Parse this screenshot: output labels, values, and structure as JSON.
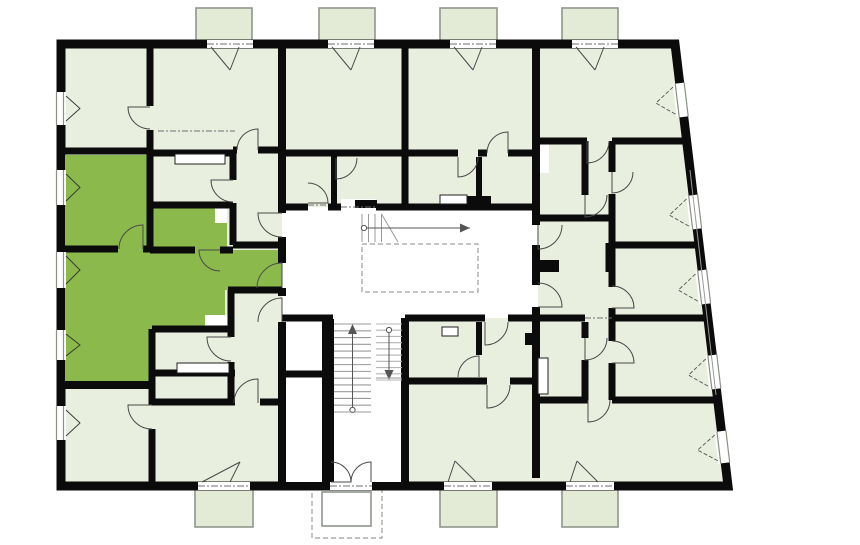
{
  "plan": {
    "canvas": {
      "width": 860,
      "height": 545,
      "background": "#ffffff"
    },
    "palette": {
      "room_fill": "#e9efdf",
      "balcony_fill": "#e3ebd7",
      "highlight_fill": "#8bb94c",
      "wall": "#0b0b0b",
      "door_stroke": "#4a4a4a",
      "window_frame": "#8b9185",
      "stair_tread": "#9a9a9a",
      "stair_tread_light": "#b5b5b5",
      "arrow": "#555555",
      "dash": "#6f6f6f",
      "balcony_stroke": "#8f968c",
      "canopy_stroke": "#a9ada3",
      "site_line": "#9a9a9a",
      "fixture_stroke": "#222222"
    },
    "footprint": {
      "points": "61,44 675,44 728,486 61,486",
      "wall_width": 9
    },
    "white_areas": {
      "corridor_path": "M282,207 L527,207 Q538,207 538,218 L538,308 Q538,318 527,318 L282,318 Z",
      "stair_block": {
        "x": 282,
        "y": 318,
        "w": 123,
        "h": 164
      }
    },
    "highlight_apartment": {
      "points": "65,155 150,155 150,208 227,208 227,250 282,250 282,290 225,290 225,329 152,329 152,385 65,385"
    },
    "white_rects": [
      {
        "x": 215,
        "y": 206,
        "w": 12,
        "h": 17
      },
      {
        "x": 205,
        "y": 315,
        "w": 23,
        "h": 14
      },
      {
        "x": 537,
        "y": 142,
        "w": 12,
        "h": 31
      },
      {
        "x": 341,
        "y": 199,
        "w": 35,
        "h": 9
      }
    ],
    "walls": [
      [
        61,
        151,
        150,
        151,
        7
      ],
      [
        150,
        153,
        233,
        153,
        7
      ],
      [
        150,
        205,
        233,
        205,
        7
      ],
      [
        61,
        249,
        118,
        249,
        7
      ],
      [
        143,
        249,
        152,
        249,
        7
      ],
      [
        150,
        250,
        195,
        250,
        7
      ],
      [
        220,
        250,
        233,
        250,
        7
      ],
      [
        233,
        245,
        282,
        245,
        7
      ],
      [
        233,
        150,
        237,
        150,
        7
      ],
      [
        258,
        150,
        282,
        150,
        7
      ],
      [
        285,
        153,
        405,
        153,
        7
      ],
      [
        405,
        153,
        458,
        153,
        7
      ],
      [
        478,
        153,
        487,
        153,
        7
      ],
      [
        508,
        153,
        536,
        153,
        7
      ],
      [
        536,
        141,
        587,
        141,
        7
      ],
      [
        612,
        141,
        688,
        141,
        7
      ],
      [
        536,
        218,
        612,
        218,
        7
      ],
      [
        612,
        245,
        698,
        245,
        7
      ],
      [
        533,
        266,
        559,
        266,
        11
      ],
      [
        282,
        207,
        308,
        207,
        7
      ],
      [
        328,
        207,
        341,
        207,
        7
      ],
      [
        376,
        207,
        538,
        207,
        7
      ],
      [
        282,
        318,
        333,
        318,
        7
      ],
      [
        405,
        318,
        485,
        318,
        7
      ],
      [
        508,
        318,
        538,
        318,
        7
      ],
      [
        536,
        318,
        585,
        318,
        7
      ],
      [
        612,
        318,
        707,
        318,
        7
      ],
      [
        282,
        374,
        328,
        374,
        7
      ],
      [
        405,
        381,
        487,
        381,
        7
      ],
      [
        510,
        381,
        536,
        381,
        7
      ],
      [
        536,
        400,
        588,
        400,
        7
      ],
      [
        612,
        400,
        715,
        400,
        7
      ],
      [
        228,
        290,
        282,
        290,
        7
      ],
      [
        152,
        329,
        231,
        329,
        7
      ],
      [
        152,
        373,
        235,
        373,
        7
      ],
      [
        152,
        402,
        235,
        402,
        7
      ],
      [
        260,
        402,
        282,
        402,
        7
      ],
      [
        61,
        385,
        152,
        385,
        8
      ],
      [
        150,
        44,
        150,
        106,
        7
      ],
      [
        150,
        130,
        150,
        250,
        7
      ],
      [
        282,
        44,
        282,
        213,
        8
      ],
      [
        282,
        237,
        282,
        263,
        8
      ],
      [
        282,
        288,
        282,
        296,
        8
      ],
      [
        282,
        322,
        282,
        482,
        8
      ],
      [
        405,
        44,
        405,
        207,
        7
      ],
      [
        405,
        318,
        405,
        482,
        8
      ],
      [
        536,
        44,
        536,
        225,
        8
      ],
      [
        536,
        245,
        536,
        285,
        8
      ],
      [
        536,
        307,
        536,
        478,
        8
      ],
      [
        233,
        150,
        233,
        180,
        7
      ],
      [
        233,
        203,
        233,
        245,
        7
      ],
      [
        231,
        290,
        231,
        337,
        7
      ],
      [
        231,
        362,
        231,
        402,
        7
      ],
      [
        328,
        319,
        328,
        482,
        12
      ],
      [
        334,
        153,
        334,
        207,
        6
      ],
      [
        479,
        157,
        479,
        207,
        6
      ],
      [
        479,
        322,
        479,
        355,
        6
      ],
      [
        585,
        141,
        585,
        195,
        7
      ],
      [
        585,
        322,
        585,
        338,
        7
      ],
      [
        585,
        360,
        585,
        400,
        7
      ],
      [
        609,
        243,
        609,
        272,
        7
      ],
      [
        612,
        141,
        612,
        172,
        7
      ],
      [
        612,
        194,
        612,
        287,
        7
      ],
      [
        612,
        308,
        612,
        341,
        7
      ],
      [
        612,
        363,
        612,
        400,
        7
      ],
      [
        152,
        329,
        152,
        385,
        7
      ],
      [
        152,
        385,
        152,
        405,
        7
      ],
      [
        152,
        429,
        152,
        482,
        7
      ]
    ],
    "black_rects": [
      {
        "x": 467,
        "y": 196,
        "w": 24,
        "h": 8
      },
      {
        "x": 533,
        "y": 260,
        "w": 26,
        "h": 12
      },
      {
        "x": 525,
        "y": 333,
        "w": 9,
        "h": 12
      },
      {
        "x": 355,
        "y": 200,
        "w": 22,
        "h": 8
      }
    ],
    "balconies": [
      {
        "x": 196,
        "y": 8,
        "w": 56,
        "h": 36,
        "side": "top"
      },
      {
        "x": 319,
        "y": 8,
        "w": 56,
        "h": 36,
        "side": "top"
      },
      {
        "x": 440,
        "y": 8,
        "w": 57,
        "h": 36,
        "side": "top"
      },
      {
        "x": 562,
        "y": 8,
        "w": 56,
        "h": 36,
        "side": "top"
      },
      {
        "x": 195,
        "y": 486,
        "w": 58,
        "h": 41,
        "side": "bottom"
      },
      {
        "x": 440,
        "y": 486,
        "w": 57,
        "h": 41,
        "side": "bottom"
      },
      {
        "x": 562,
        "y": 486,
        "w": 56,
        "h": 41,
        "side": "bottom"
      }
    ],
    "canopy": {
      "outer": {
        "x": 312,
        "y": 486,
        "w": 70,
        "h": 52
      },
      "inner": {
        "x": 322,
        "y": 492,
        "w": 49,
        "h": 34
      }
    },
    "thresholds": [
      {
        "x": 207,
        "y": 40,
        "w": 46,
        "h": 8
      },
      {
        "x": 328,
        "y": 40,
        "w": 46,
        "h": 8
      },
      {
        "x": 450,
        "y": 40,
        "w": 46,
        "h": 8
      },
      {
        "x": 572,
        "y": 40,
        "w": 46,
        "h": 8
      },
      {
        "x": 198,
        "y": 482,
        "w": 52,
        "h": 8
      },
      {
        "x": 330,
        "y": 482,
        "w": 42,
        "h": 8
      },
      {
        "x": 444,
        "y": 482,
        "w": 48,
        "h": 8
      },
      {
        "x": 566,
        "y": 482,
        "w": 48,
        "h": 8
      }
    ],
    "fixtures": [
      {
        "x": 175,
        "y": 154,
        "w": 50,
        "h": 10
      },
      {
        "x": 177,
        "y": 363,
        "w": 52,
        "h": 10
      },
      {
        "x": 440,
        "y": 195,
        "w": 27,
        "h": 9
      },
      {
        "x": 442,
        "y": 327,
        "w": 16,
        "h": 9
      },
      {
        "x": 538,
        "y": 358,
        "w": 10,
        "h": 36
      }
    ],
    "windows_left": [
      {
        "y": 92,
        "h": 33
      },
      {
        "y": 170,
        "h": 35
      },
      {
        "y": 252,
        "h": 36
      },
      {
        "y": 330,
        "h": 30
      },
      {
        "y": 406,
        "h": 34
      }
    ],
    "windows_slant": [
      {
        "yc": 100,
        "h": 34
      },
      {
        "yc": 212,
        "h": 34
      },
      {
        "yc": 287,
        "h": 34
      },
      {
        "yc": 372,
        "h": 34
      },
      {
        "yc": 447,
        "h": 32
      }
    ],
    "slant": {
      "x_at_y44": 675,
      "dx_per_dy": 0.1199,
      "angle_deg": -6.84
    },
    "doors": [
      {
        "cx": 150,
        "cy": 107,
        "r": 22,
        "a1": 90,
        "a2": 180
      },
      {
        "cx": 258,
        "cy": 150,
        "r": 21,
        "a1": 180,
        "a2": 270
      },
      {
        "cx": 233,
        "cy": 180,
        "r": 22,
        "a1": 90,
        "a2": 180
      },
      {
        "cx": 220,
        "cy": 250,
        "r": 21,
        "a1": 90,
        "a2": 180
      },
      {
        "cx": 143,
        "cy": 249,
        "r": 24,
        "a1": 180,
        "a2": 270
      },
      {
        "cx": 282,
        "cy": 288,
        "r": 25,
        "a1": 180,
        "a2": 270
      },
      {
        "cx": 282,
        "cy": 213,
        "r": 24,
        "a1": 90,
        "a2": 180
      },
      {
        "cx": 308,
        "cy": 203,
        "r": 20,
        "a1": 270,
        "a2": 360
      },
      {
        "cx": 336,
        "cy": 158,
        "r": 21,
        "a1": 0,
        "a2": 90
      },
      {
        "cx": 587,
        "cy": 141,
        "r": 22,
        "a1": 0,
        "a2": 90
      },
      {
        "cx": 538,
        "cy": 225,
        "r": 24,
        "a1": 0,
        "a2": 90
      },
      {
        "cx": 538,
        "cy": 307,
        "r": 24,
        "a1": 270,
        "a2": 360
      },
      {
        "cx": 612,
        "cy": 172,
        "r": 21,
        "a1": 0,
        "a2": 90
      },
      {
        "cx": 612,
        "cy": 308,
        "r": 22,
        "a1": 270,
        "a2": 360
      },
      {
        "cx": 585,
        "cy": 195,
        "r": 22,
        "a1": 0,
        "a2": 90
      },
      {
        "cx": 612,
        "cy": 363,
        "r": 22,
        "a1": 270,
        "a2": 360
      },
      {
        "cx": 585,
        "cy": 338,
        "r": 22,
        "a1": 0,
        "a2": 90
      },
      {
        "cx": 588,
        "cy": 400,
        "r": 22,
        "a1": 0,
        "a2": 90
      },
      {
        "cx": 485,
        "cy": 322,
        "r": 23,
        "a1": 0,
        "a2": 90
      },
      {
        "cx": 479,
        "cy": 377,
        "r": 21,
        "a1": 180,
        "a2": 270
      },
      {
        "cx": 487,
        "cy": 385,
        "r": 23,
        "a1": 0,
        "a2": 90
      },
      {
        "cx": 282,
        "cy": 322,
        "r": 24,
        "a1": 180,
        "a2": 270
      },
      {
        "cx": 231,
        "cy": 337,
        "r": 24,
        "a1": 90,
        "a2": 180
      },
      {
        "cx": 258,
        "cy": 403,
        "r": 24,
        "a1": 180,
        "a2": 270
      },
      {
        "cx": 152,
        "cy": 405,
        "r": 24,
        "a1": 90,
        "a2": 180
      },
      {
        "cx": 508,
        "cy": 153,
        "r": 21,
        "a1": 180,
        "a2": 270
      },
      {
        "cx": 458,
        "cy": 157,
        "r": 20,
        "a1": 0,
        "a2": 90
      },
      {
        "cx": 331,
        "cy": 482,
        "r": 20,
        "a1": 270,
        "a2": 360
      },
      {
        "cx": 371,
        "cy": 482,
        "r": 20,
        "a1": 180,
        "a2": 270
      }
    ],
    "fans": [
      {
        "x1": 211,
        "y1": 47,
        "x2": 239,
        "y2": 47,
        "ax": 230,
        "ay": 70
      },
      {
        "x1": 332,
        "y1": 47,
        "x2": 360,
        "y2": 47,
        "ax": 351,
        "ay": 70
      },
      {
        "x1": 454,
        "y1": 47,
        "x2": 482,
        "y2": 47,
        "ax": 473,
        "ay": 70
      },
      {
        "x1": 576,
        "y1": 47,
        "x2": 604,
        "y2": 47,
        "ax": 595,
        "ay": 70
      },
      {
        "x1": 202,
        "y1": 482,
        "x2": 230,
        "y2": 482,
        "ax": 240,
        "ay": 462
      },
      {
        "x1": 448,
        "y1": 482,
        "x2": 476,
        "y2": 482,
        "ax": 455,
        "ay": 461
      },
      {
        "x1": 570,
        "y1": 482,
        "x2": 598,
        "y2": 482,
        "ax": 577,
        "ay": 461
      }
    ],
    "stairs": {
      "flight_up": {
        "x": 334,
        "y": 324,
        "w": 37,
        "h": 88,
        "steps": 13
      },
      "flight_down": {
        "x": 376,
        "y": 324,
        "w": 26,
        "h": 56,
        "steps": 9
      },
      "ramp": {
        "tread_xs": [
          362,
          368.5,
          375,
          381.5
        ],
        "y1": 214,
        "y2": 242,
        "diag": {
          "x1": 381.5,
          "y1": 214,
          "x2": 398,
          "y2": 242
        },
        "arrow": {
          "x1": 364,
          "x2": 470,
          "y": 228
        }
      },
      "void_rect": {
        "x": 362,
        "y": 244,
        "w": 116,
        "h": 48
      },
      "landing_lines": [
        [
          334,
          412,
          371,
          412
        ],
        [
          376,
          378,
          402,
          378
        ]
      ]
    },
    "dash_lines": [
      [
        341,
        207,
        376,
        207
      ],
      [
        308,
        205,
        328,
        205
      ],
      [
        158,
        131,
        235,
        131
      ],
      [
        585,
        318,
        612,
        318
      ]
    ],
    "site_line": {
      "x1": 690,
      "y1": 170,
      "x2": 716,
      "y2": 395
    }
  }
}
